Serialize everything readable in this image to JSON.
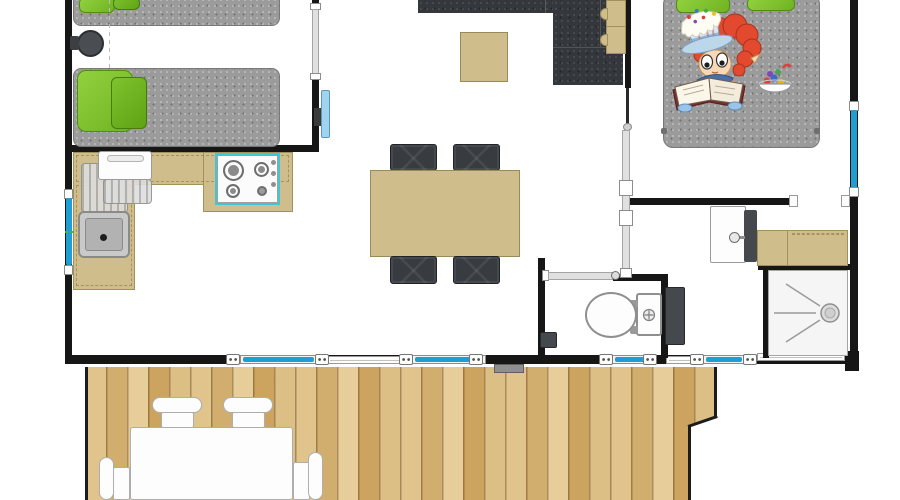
{
  "plan": {
    "kind": "holiday-home floor plan, top-down view, no text labels",
    "rooms": [
      {
        "id": "twin-bedroom",
        "position": "top-left",
        "furniture": [
          "single-bed-top (cropped)",
          "single-bed-bottom",
          "round-bedside-stool",
          "wall-mounted-tv"
        ]
      },
      {
        "id": "kitchen",
        "position": "left-middle",
        "furniture": [
          "l-shaped-counter",
          "white-appliance-fridge",
          "drainboard-ribs",
          "sink-with-drain",
          "gas-hob-4-burners"
        ]
      },
      {
        "id": "living-dining",
        "position": "center",
        "furniture": [
          "corner-sofa (cropped top)",
          "coffee-table",
          "shelf-unit",
          "dining-table",
          "dining-chairs x4"
        ]
      },
      {
        "id": "double-bedroom",
        "position": "top-right",
        "furniture": [
          "double-bed",
          "green-pillows x2",
          "reading-child-illustration",
          "candy-bowl-illustration"
        ]
      },
      {
        "id": "bathroom",
        "position": "right",
        "furniture": [
          "washbasin-with-faucet",
          "beige-counter",
          "shower-tray-with-drain",
          "water-heater"
        ]
      },
      {
        "id": "wc",
        "position": "bottom-center",
        "furniture": [
          "toilet-with-cistern",
          "flush-button",
          "small-wall-box"
        ]
      },
      {
        "id": "terrace",
        "position": "bottom",
        "floor": "vertical wood planks",
        "furniture": [
          "outdoor-table",
          "outdoor-chairs x4",
          "door-mat"
        ]
      }
    ],
    "openings": {
      "side_windows": [
        {
          "wall": "left",
          "glazing": "blue"
        },
        {
          "wall": "right",
          "glazing": "blue"
        }
      ],
      "bottom_wall_glazed_panels": 4,
      "bottom_wall_latch_icons": 8,
      "sliding_doors": [
        "twin-bedroom-entry",
        "double-bedroom-entry"
      ],
      "hinged_doors": [
        "wc-door"
      ],
      "doorways": [
        "bedroom-to-bathroom"
      ]
    },
    "illustration": {
      "subject": "red-haired child with icing-cake hat reading an open book on the bed, bowl of candies beside"
    }
  },
  "palette": {
    "wall": "#161616",
    "floor": "#ffffff",
    "window_glass": "#1e9fd4",
    "mattress_gray": "#9b9b9b",
    "sofa_charcoal": "#34373b",
    "pillow_green": "#7ec226",
    "furniture_beige": "#cfbe8c",
    "deck_wood": "#d9b97f",
    "tv_screen": "#9fd3ef",
    "hob_highlight": "#3fc6d8",
    "fixture_white": "#fdfdfd",
    "dark_unit": "#45484d",
    "hair_red": "#e2492f",
    "window_marker_green": "#39b54a"
  }
}
